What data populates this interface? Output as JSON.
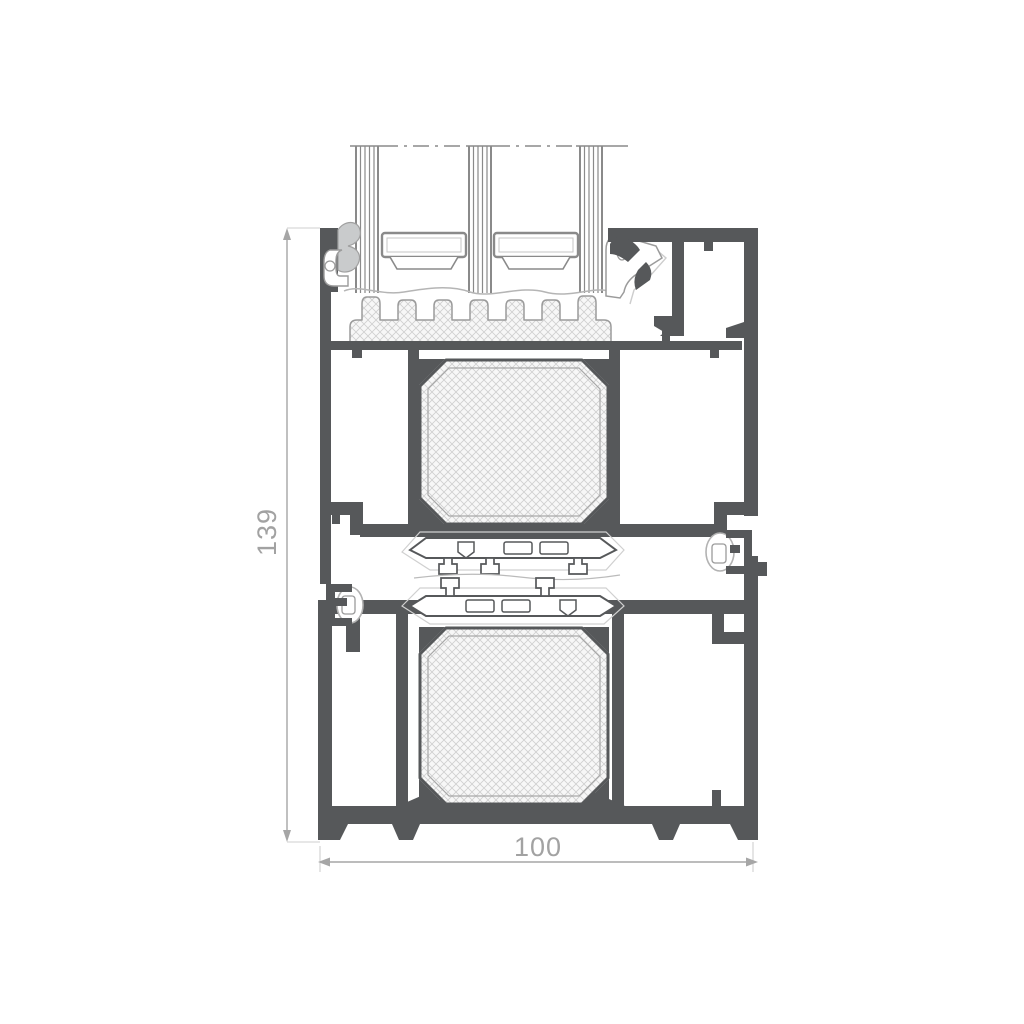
{
  "diagram": {
    "type": "technical-cross-section",
    "subject": "aluminium window profile section (sash on frame with triple glazing)",
    "dimension_height": {
      "value": "139",
      "orientation": "vertical"
    },
    "dimension_width": {
      "value": "100",
      "orientation": "horizontal"
    },
    "colors": {
      "background": "#ffffff",
      "profile_metal": "#56585a",
      "outline_light": "#9b9b9b",
      "gasket_fill": "#c9cbcc",
      "hatch_line": "#cfcfcf",
      "hatch_background": "#f7f7f7",
      "dimension_line": "#a6a6a6",
      "dimension_text": "#a2a2a2"
    }
  }
}
